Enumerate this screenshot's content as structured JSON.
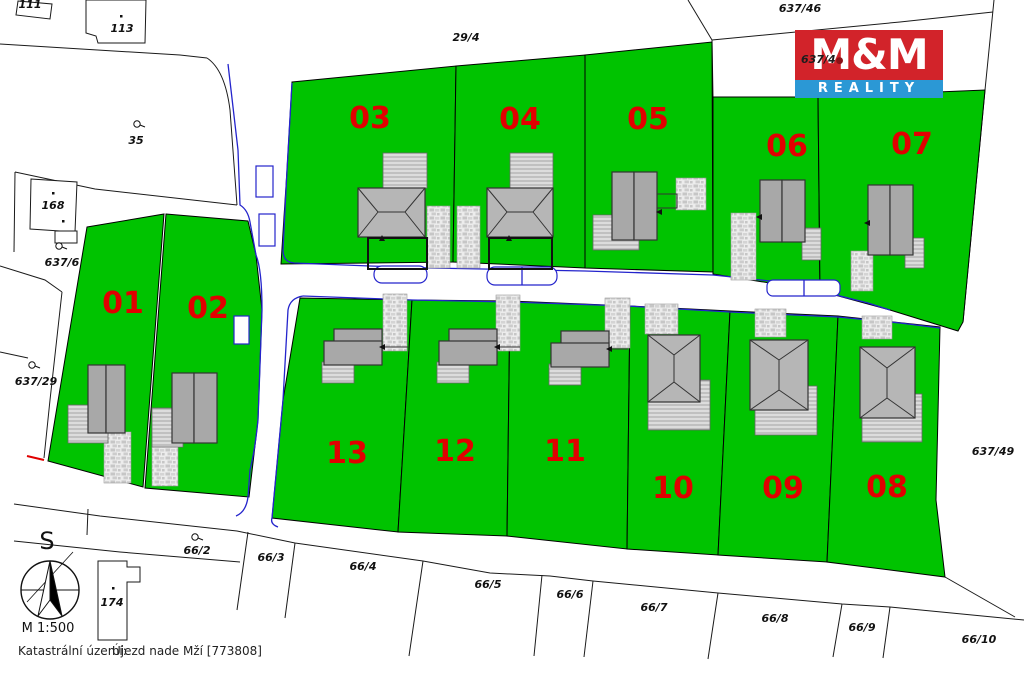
{
  "plots": {
    "numbers": [
      "01",
      "02",
      "03",
      "04",
      "05",
      "06",
      "07",
      "08",
      "09",
      "10",
      "11",
      "12",
      "13"
    ]
  },
  "parcels": {
    "p111": "111",
    "p113": "113",
    "p35": "35",
    "p168": "168",
    "p637_6": "637/6",
    "p637_29": "637/29",
    "p29_4": "29/4",
    "p637_46": "637/46",
    "p637_49": "637/49",
    "p174": "174",
    "p66_2": "66/2",
    "p66_3": "66/3",
    "p66_4": "66/4",
    "p66_5": "66/5",
    "p66_6": "66/6",
    "p66_7": "66/7",
    "p66_8": "66/8",
    "p66_9": "66/9",
    "p66_10": "66/10",
    "logo_overlay": "637/4"
  },
  "logo": {
    "top": "M&M",
    "bottom": "REALITY",
    "red": "#d2232a",
    "blue": "#2b98d5"
  },
  "compass": {
    "north": "S",
    "scale": "M 1:500"
  },
  "footer": {
    "label": "Katastrální území:",
    "value": "Újezd nade Mží [773808]"
  },
  "colors": {
    "plot_green": "#00c300",
    "number_red": "#e10000",
    "road_blue": "#2424cc"
  }
}
